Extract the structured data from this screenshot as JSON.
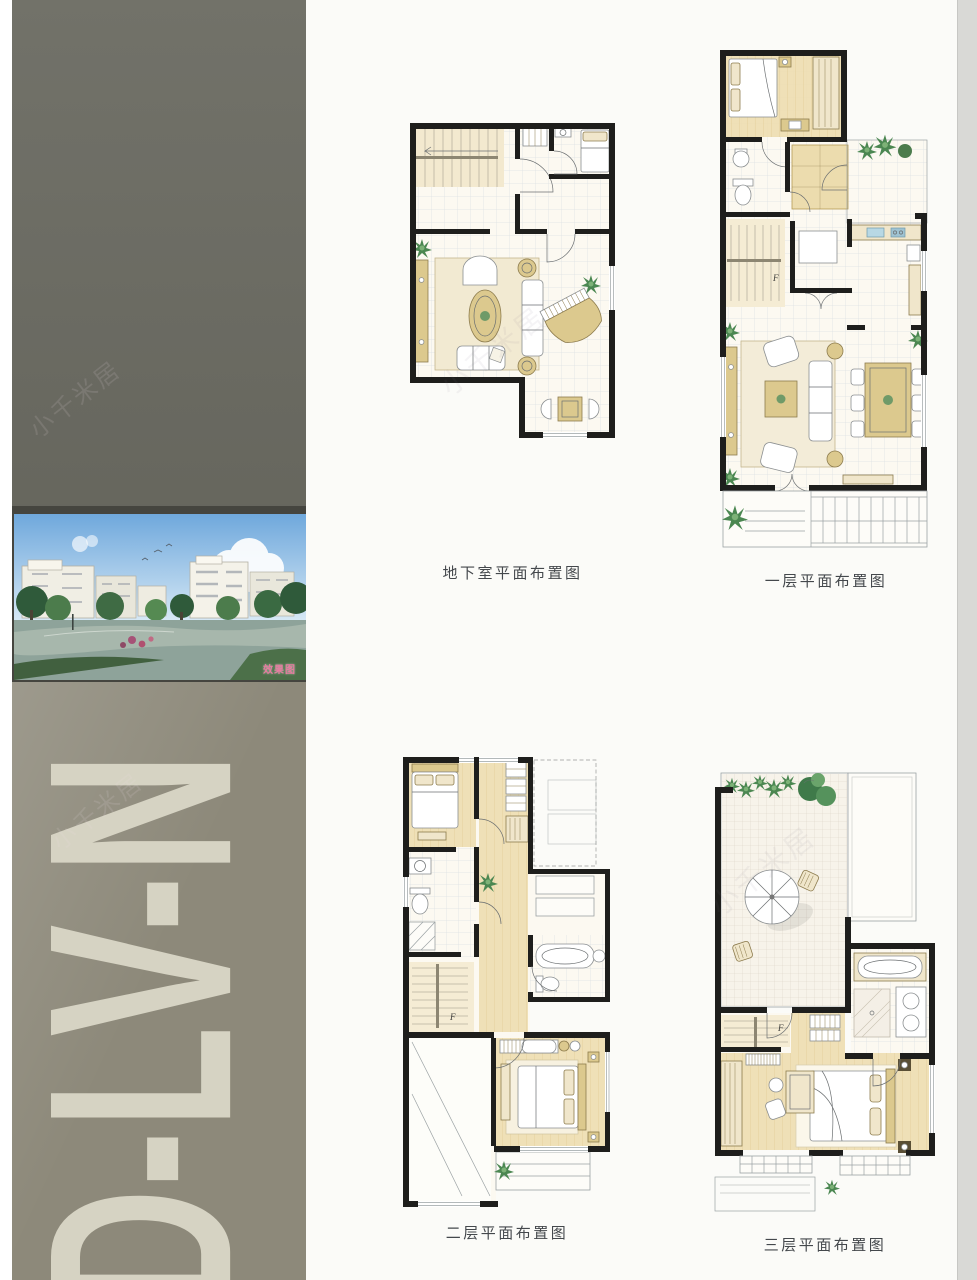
{
  "sidebar": {
    "unit_code": "D-LV-N",
    "photo_label": "效果图"
  },
  "watermark": {
    "text": "小千米居"
  },
  "plans": [
    {
      "id": "basement",
      "caption": "地下室平面布置图"
    },
    {
      "id": "floor-1",
      "caption": "一层平面布置图"
    },
    {
      "id": "floor-2",
      "caption": "二层平面布置图"
    },
    {
      "id": "floor-3",
      "caption": "三层平面布置图"
    }
  ],
  "stair_label": "F",
  "colors": {
    "wall": "#1e1e1c",
    "floor_cream": "#fcf9f1",
    "wood": "#ecdcae",
    "furniture_tan": "#dcc98e",
    "plant_green": "#4b8751",
    "sink_blue": "#b8d8e4",
    "sidebar_top": "#6c6c63",
    "sidebar_bottom": "#8d897a",
    "sidebar_letters": "#d6d3c3",
    "photo_label_pink": "#e87ba0",
    "caption_text": "#44484c"
  }
}
